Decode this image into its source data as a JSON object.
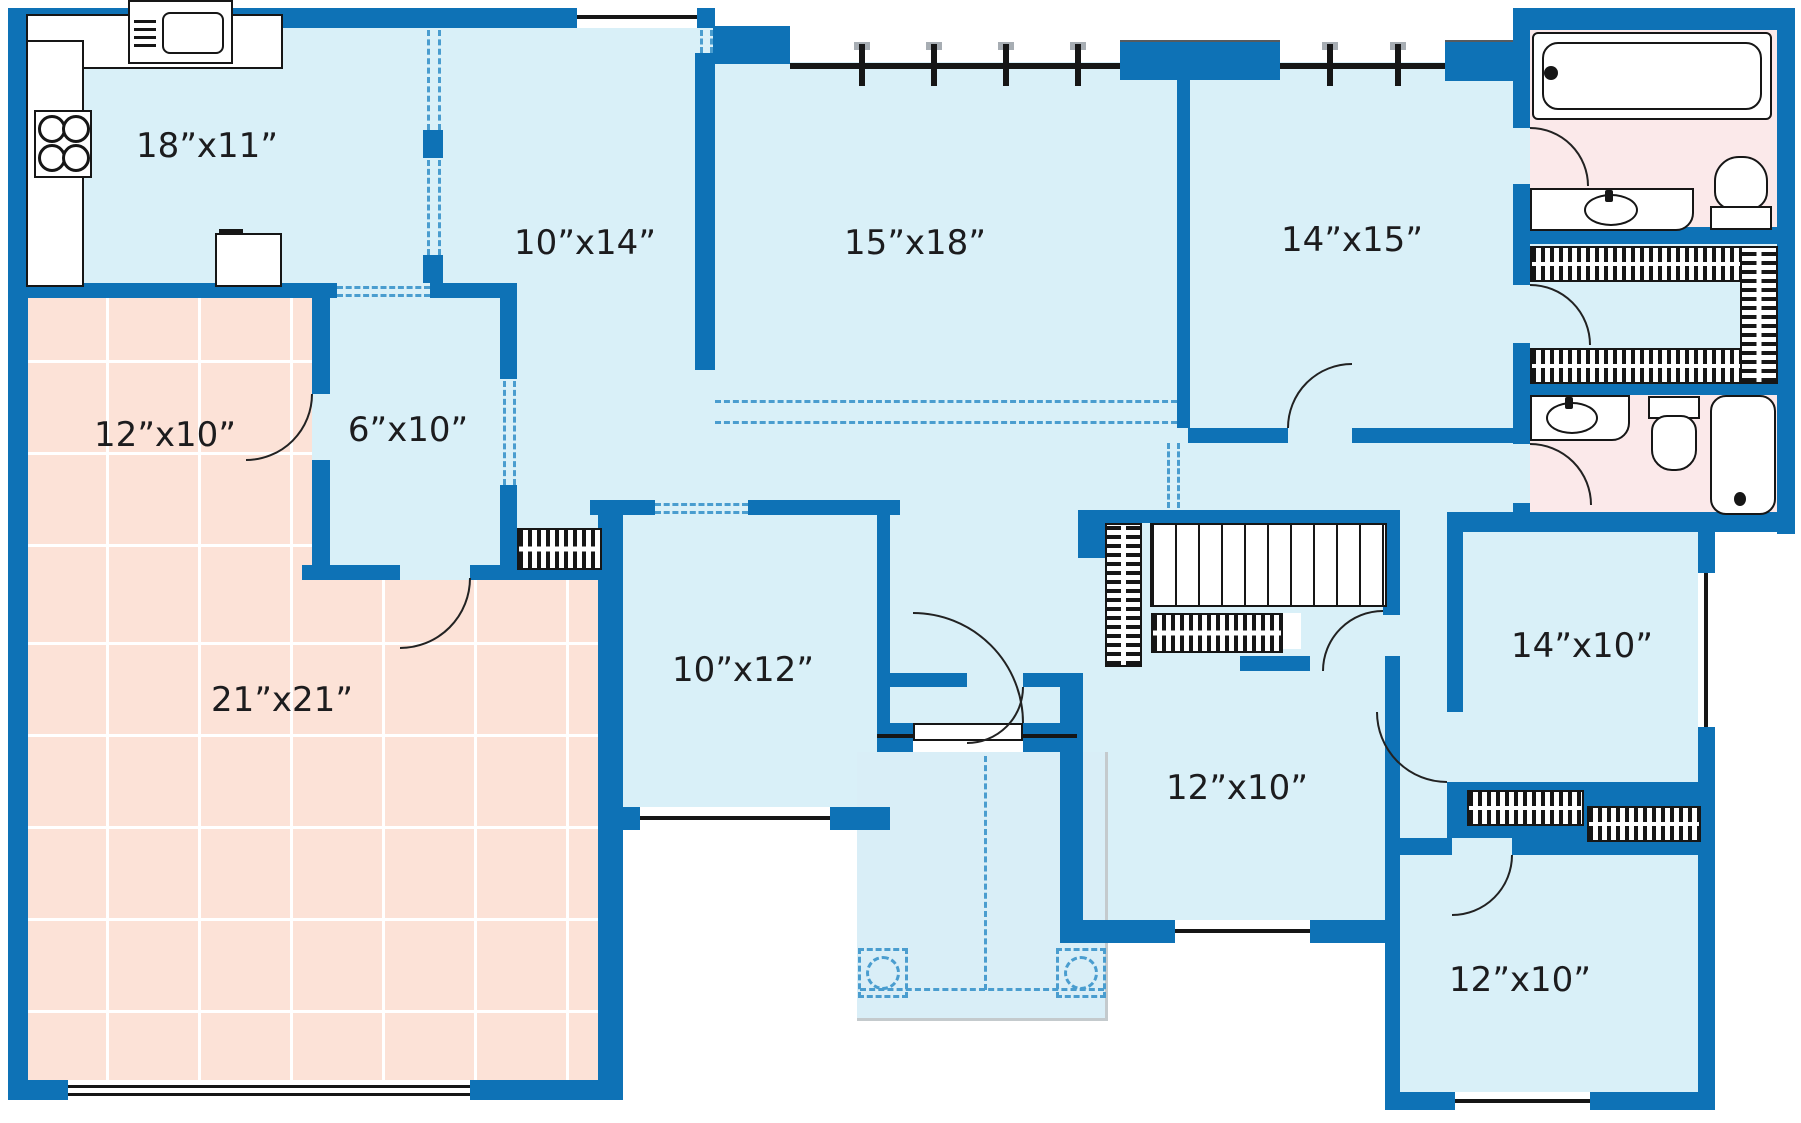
{
  "colors": {
    "wall": "#0e72b6",
    "floor": "#d9f0f8",
    "garage_floor": "#fce2d7",
    "bath_floor": "#fbe9ea",
    "porch": "#d9eef7",
    "dash": "#4a9dcf",
    "outline": "#161616"
  },
  "rooms": [
    {
      "id": "kitchen",
      "label": "18”x11”"
    },
    {
      "id": "dining-room",
      "label": "10”x14”"
    },
    {
      "id": "living-room",
      "label": "15”x18”"
    },
    {
      "id": "master-bedroom",
      "label": "14”x15”"
    },
    {
      "id": "mudroom",
      "label": "6”x10”"
    },
    {
      "id": "garage-bay",
      "label": "12”x10”"
    },
    {
      "id": "garage",
      "label": "21”x21”"
    },
    {
      "id": "study",
      "label": "10”x12”"
    },
    {
      "id": "bedroom-2",
      "label": "12”x10”"
    },
    {
      "id": "bedroom-3",
      "label": "14”x10”"
    },
    {
      "id": "bedroom-4",
      "label": "12”x10”"
    }
  ]
}
